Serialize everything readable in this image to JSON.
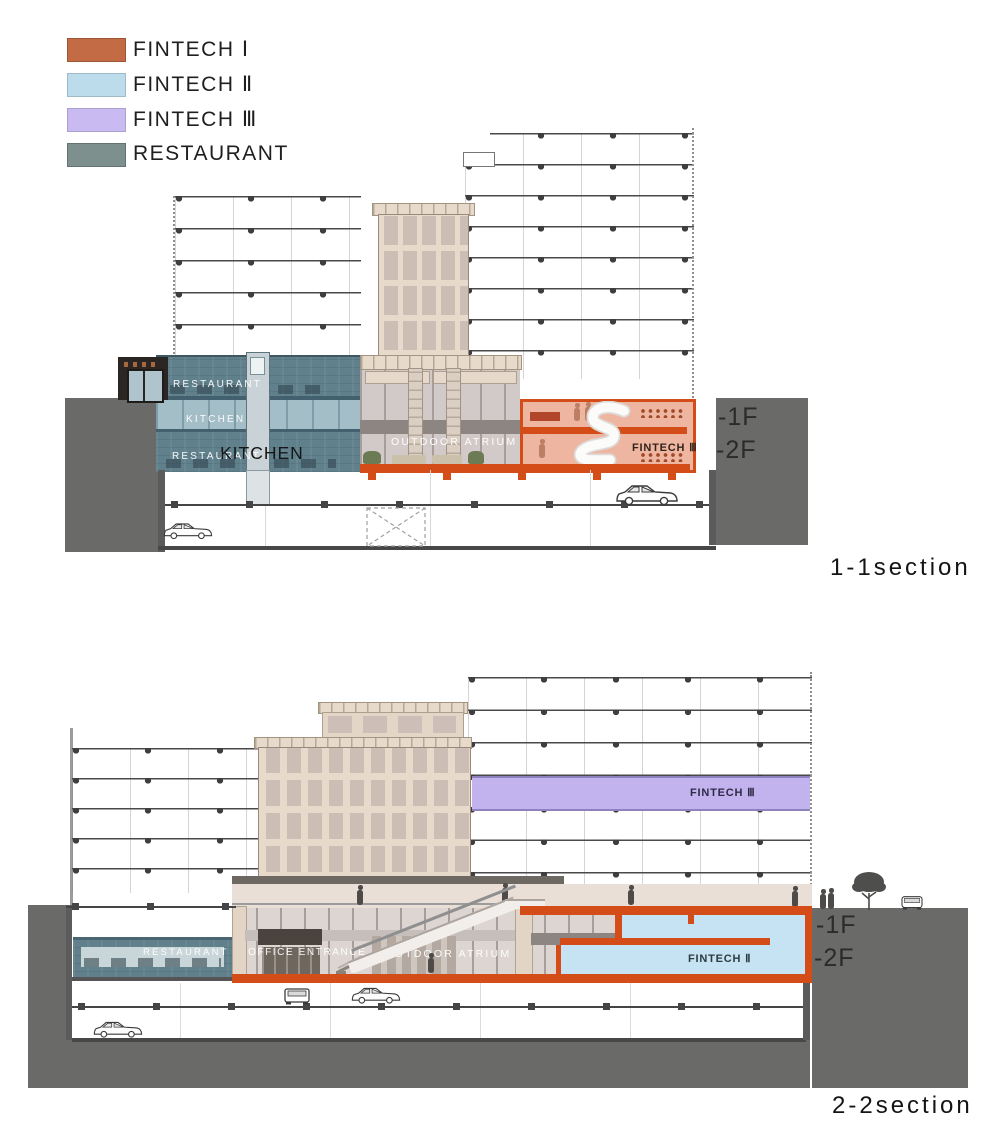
{
  "legend": {
    "items": [
      {
        "label": "FINTECH Ⅰ",
        "color": "#C36B44"
      },
      {
        "label": "FINTECH Ⅱ",
        "color": "#BCDCEB"
      },
      {
        "label": "FINTECH Ⅲ",
        "color": "#C9BBF1"
      },
      {
        "label": "RESTAURANT",
        "color": "#7D908E"
      }
    ]
  },
  "section1": {
    "title": "1-1section",
    "labels": {
      "restaurant_upper": "RESTAURANT",
      "kitchen_band": "KITCHEN",
      "restaurant_lower": "RESTAURANT",
      "kitchen_large": "KITCHEN",
      "outdoor_atrium": "OUTDOOR ATRIUM",
      "fintech_room": "FINTECH Ⅲ",
      "floor_minus_1": "-1F",
      "floor_minus_2": "-2F"
    }
  },
  "section2": {
    "title": "2-2section",
    "labels": {
      "fintech3_band": "FINTECH Ⅲ",
      "restaurant": "RESTAURANT",
      "office_entrance": "OFFICE ENTRANCE",
      "outdoor_atrium": "OUTDOOR ATRIUM",
      "fintech2_room": "FINTECH Ⅱ",
      "floor_minus_1": "-1F",
      "floor_minus_2": "-2F"
    }
  },
  "colors": {
    "fintech1_orange": "#C36B44",
    "fintech2_blue": "#BCDCEB",
    "fintech3_purple": "#C9BBF1",
    "restaurant_teal": "#7D908E",
    "zone_outline_orange": "#D44D18",
    "zone_fill_salmon": "#EEB5A0",
    "ground_gray": "#6A6A68"
  }
}
